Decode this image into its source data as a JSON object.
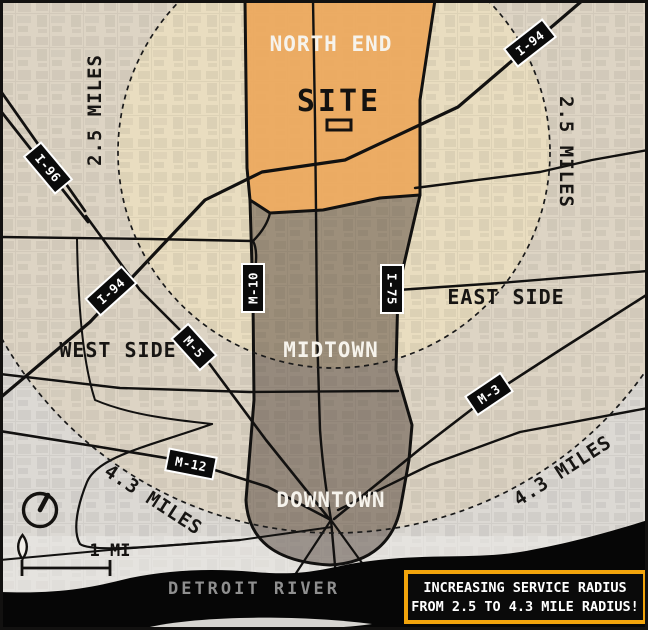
{
  "map_title": "Detroit service radius map",
  "areas": {
    "north_end": "NORTH END",
    "east_side": "EAST SIDE",
    "west_side": "WEST SIDE",
    "midtown": "MIDTOWN",
    "downtown": "DOWNTOWN"
  },
  "site": {
    "label": "SITE"
  },
  "highways": {
    "i96": "I-96",
    "i94": "I-94",
    "m10": "M-10",
    "i75": "I-75",
    "m5": "M-5",
    "m12": "M-12",
    "m3": "M-3"
  },
  "radius_rings": {
    "inner_label": "2.5 MILES",
    "outer_label": "4.3 MILES",
    "inner_radius_miles": 2.5,
    "outer_radius_miles": 4.3
  },
  "river": {
    "label": "DETROIT RIVER"
  },
  "scale_bar": {
    "label": "1 MI"
  },
  "callout": {
    "line1": "INCREASING SERVICE RADIUS",
    "line2": "FROM 2.5 TO 4.3 MILE RADIUS!"
  },
  "colors": {
    "corridor_orange": "#ECA85C",
    "corridor_gray": "rgba(64,49,41,0.45)",
    "inner_circle": "#E9DDC0",
    "ring": "#DDD4C4",
    "outside": "#DCD9D4",
    "river": "#060606",
    "badge_bg": "#0B0B0B",
    "callout_bg": "#0A0A0A",
    "callout_border": "#F2A40C"
  }
}
